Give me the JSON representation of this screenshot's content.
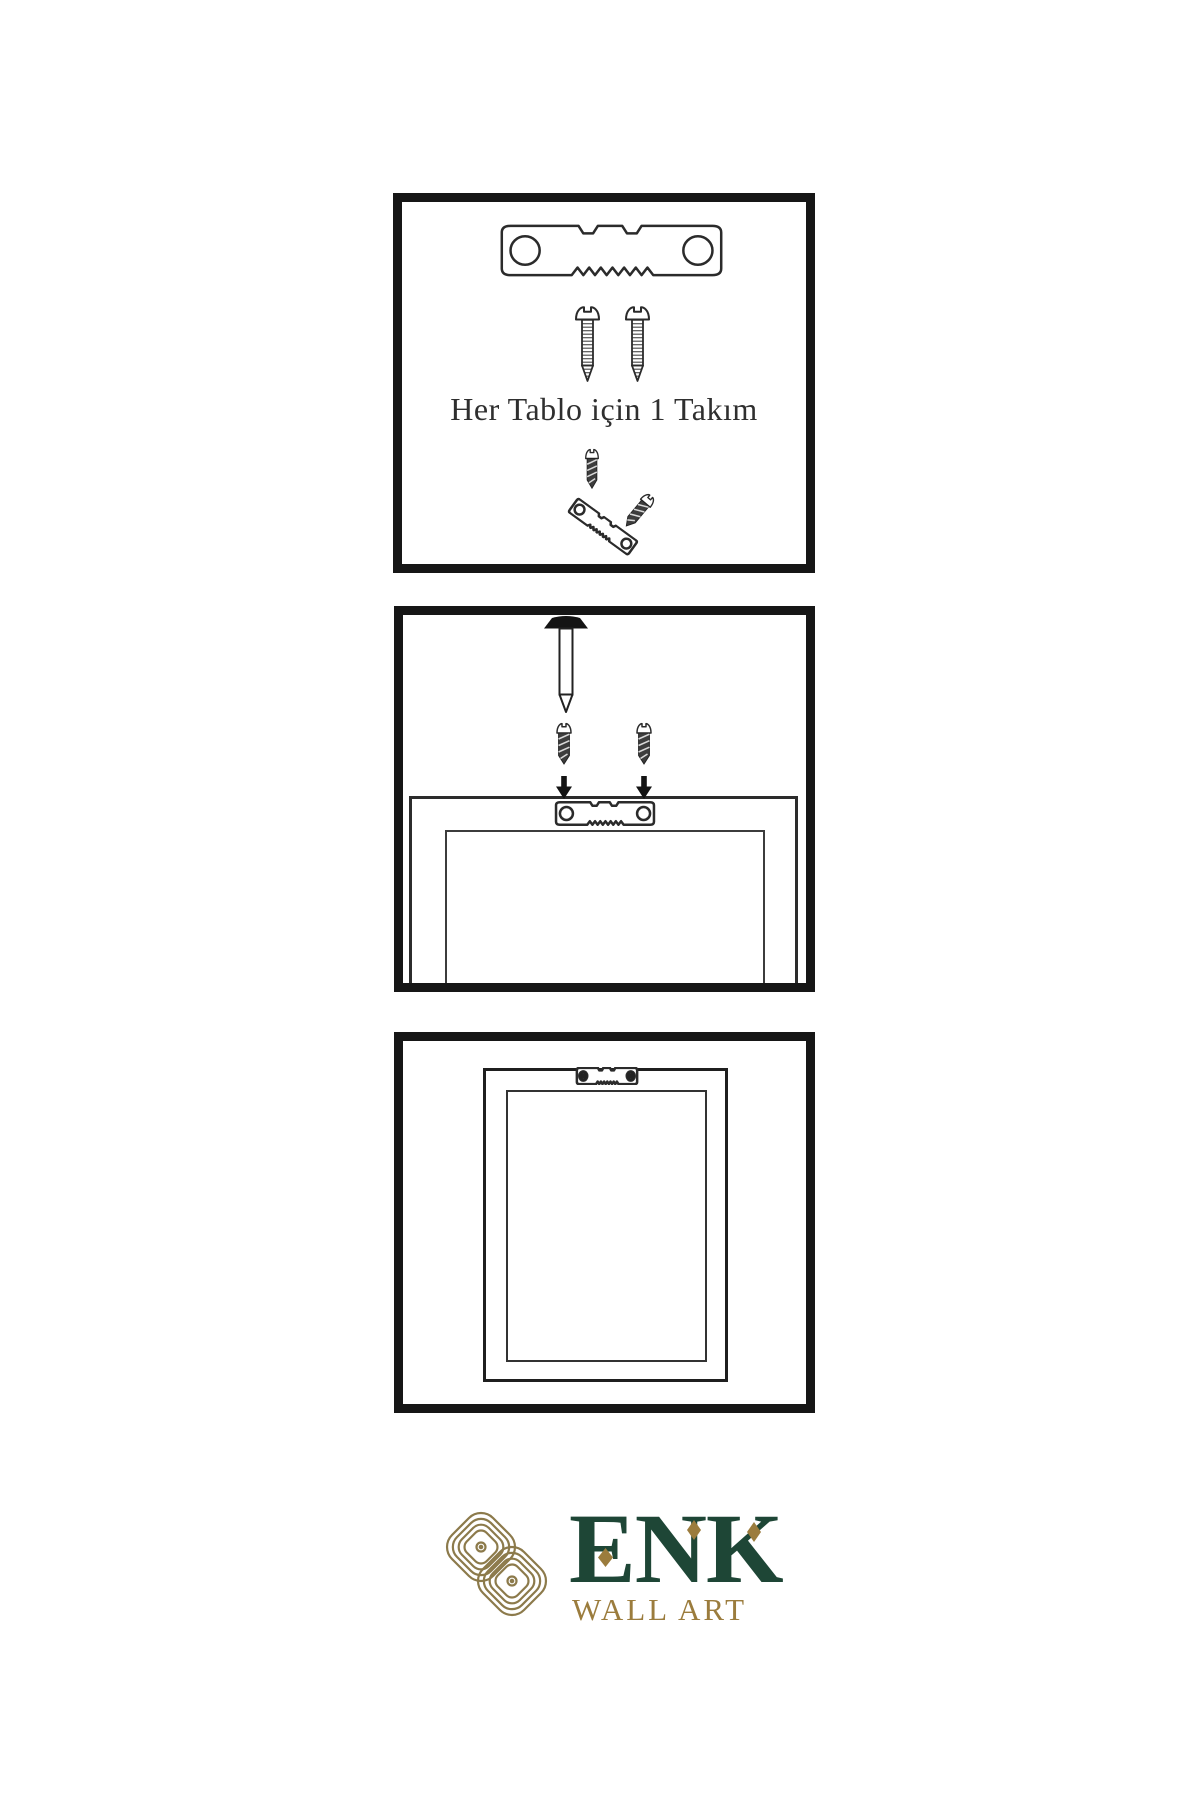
{
  "canvas": {
    "background": "#ffffff"
  },
  "colors": {
    "ink": "#2b2b2b",
    "panel_border": "#161616",
    "screw_dark": "#3d3d3d",
    "logo_green": "#1e4636",
    "logo_gold": "#9b7c3d",
    "knot_gold": "#8c7a4b"
  },
  "steps": {
    "step1": {
      "caption": "Her Tablo için 1 Takım",
      "shows": [
        "sawtooth-hanger",
        "two-screws",
        "angled-hanger-with-screws"
      ]
    },
    "step2": {
      "shows": [
        "wall-nail",
        "two-screws",
        "two-down-arrows",
        "frame-back-with-sawtooth-hanger"
      ]
    },
    "step3": {
      "shows": [
        "hung-frame-with-mounted-sawtooth-hanger"
      ]
    }
  },
  "logo": {
    "brand": "ENK",
    "subtitle": "WALL ART"
  },
  "icons": {
    "sawtooth_hanger": "sawtooth-hanger-icon",
    "sawtooth_hanger_screwed": "sawtooth-hanger-screwed-icon",
    "screw_light": "screw-icon",
    "screw_dark": "screw-dark-icon",
    "nail": "nail-icon",
    "down_arrow": "down-arrow-icon",
    "frame_back": "frame-back-icon",
    "picture_frame": "picture-frame-icon",
    "knot": "knot-logo-icon"
  }
}
